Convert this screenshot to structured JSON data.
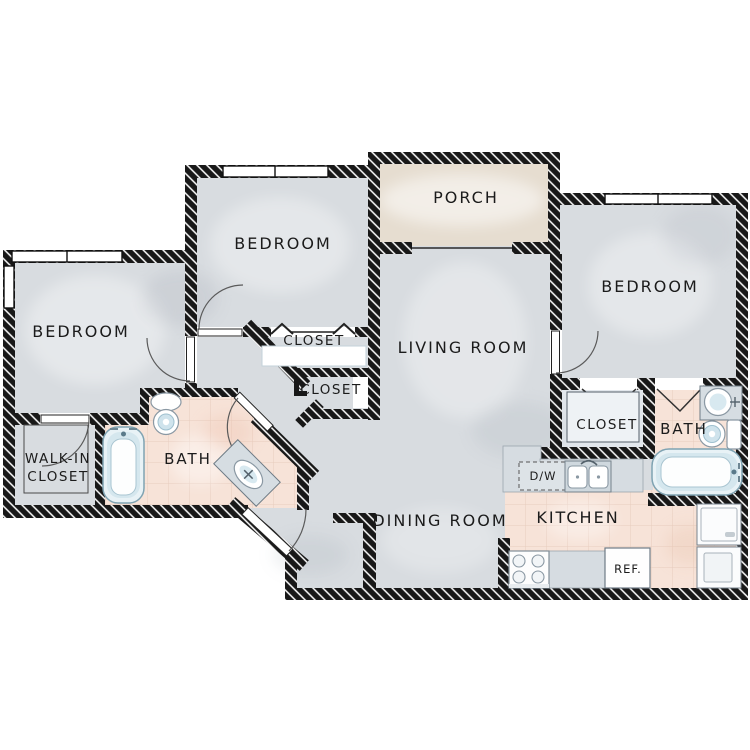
{
  "plan": {
    "rooms": {
      "porch": "PORCH",
      "bedroom_top": "BEDROOM",
      "bedroom_left": "BEDROOM",
      "bedroom_right": "BEDROOM",
      "living_room": "LIVING ROOM",
      "dining_room": "DINING ROOM",
      "kitchen": "KITCHEN",
      "bath_left": "BATH",
      "bath_right": "BATH",
      "closet_hall_upper": "CLOSET",
      "closet_hall_lower": "CLOSET",
      "closet_right": "CLOSET",
      "walk_in_closet_line1": "WALK-IN",
      "walk_in_closet_line2": "CLOSET"
    },
    "appliances": {
      "dishwasher": "D/W",
      "refrigerator": "REF."
    },
    "colors": {
      "wall": "#181818",
      "floor": "#d8dce0",
      "porch_floor": "#e6ddd0",
      "tile": "#f7e3d8",
      "tile_line": "#e7ccbe",
      "fixture_blue": "#d5e7ee",
      "counter": "#d6dce1"
    }
  }
}
